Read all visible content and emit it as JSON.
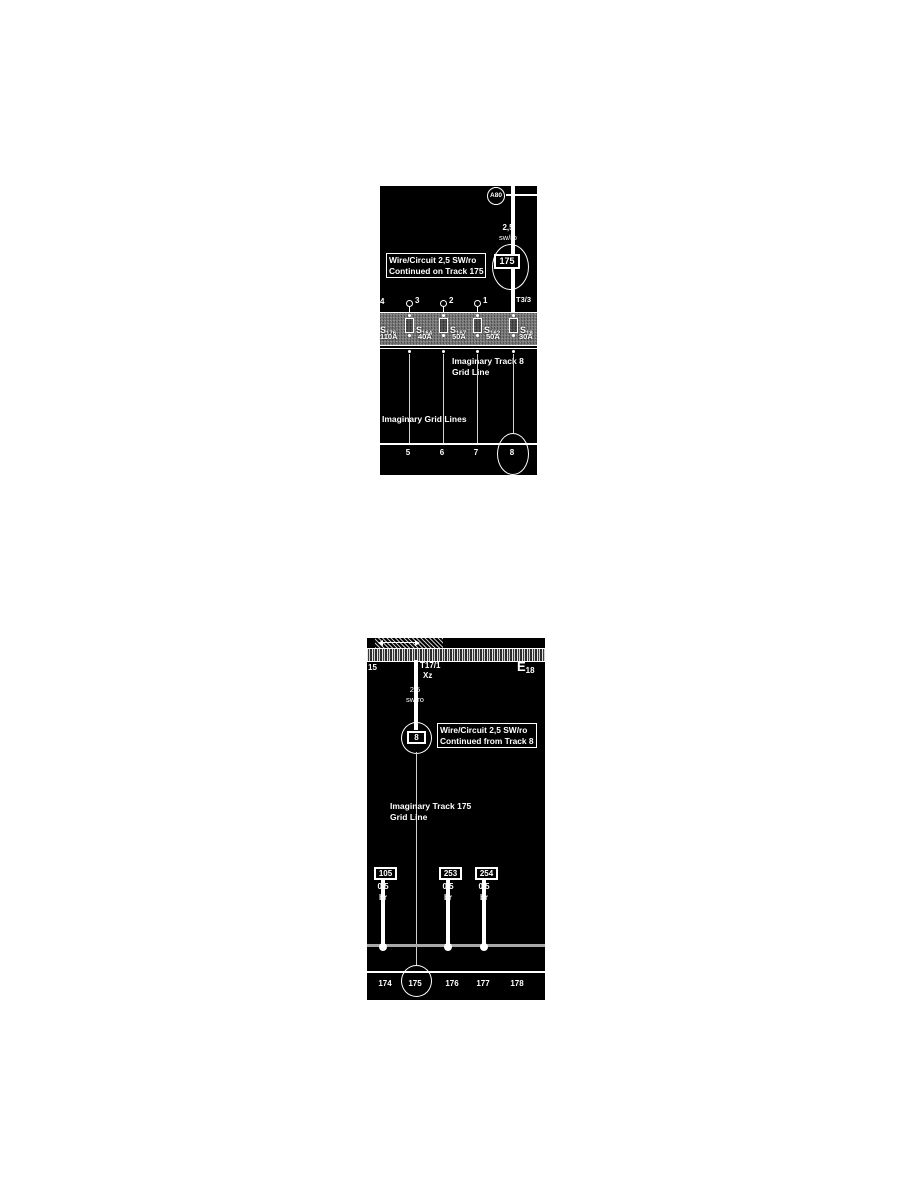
{
  "colors": {
    "page_bg": "#ffffff",
    "diagram_bg": "#000000",
    "diagram_text": "#ffffff",
    "fuse_band_gray": "#777777",
    "ground_bus_gray": "#a8a8a8"
  },
  "diagram1": {
    "component_ref": "A80",
    "wire_size": "2,5",
    "wire_color": "sw/ro",
    "track_box": "175",
    "callout": {
      "line1": "Wire/Circuit 2,5 SW/ro",
      "line2": "Continued on Track 175"
    },
    "pins": {
      "p4": "4",
      "p3": "3",
      "p2": "2",
      "p1": "1"
    },
    "connector": "T3/3",
    "fuses": [
      {
        "name": "S",
        "sub": "176",
        "amp": "110A"
      },
      {
        "name": "S",
        "sub": "164",
        "amp": "40A"
      },
      {
        "name": "S",
        "sub": "167",
        "amp": "50A"
      },
      {
        "name": "S",
        "sub": "162",
        "amp": "50A"
      },
      {
        "name": "S",
        "sub": "18",
        "amp": "30A"
      }
    ],
    "track8_note": {
      "line1": "Imaginary Track 8",
      "line2": "Grid Line"
    },
    "grid_note": "Imaginary Grid Lines",
    "tracks": [
      "5",
      "6",
      "7",
      "8"
    ],
    "circled_track": "8"
  },
  "diagram2": {
    "band_left_label": "15",
    "connector": "T17/1",
    "connector_sub": "Xz",
    "component_ref": {
      "main": "E",
      "sub": "18"
    },
    "wire_size": "2,5",
    "wire_color": "sw/ro",
    "track_box": "8",
    "callout": {
      "line1": "Wire/Circuit 2,5 SW/ro",
      "line2": "Continued from Track 8"
    },
    "track175_note": {
      "line1": "Imaginary Track 175",
      "line2": "Grid Line"
    },
    "grounds": [
      {
        "ref": "105",
        "size": "0,5",
        "color": "br"
      },
      {
        "ref": "253",
        "size": "0,5",
        "color": "br"
      },
      {
        "ref": "254",
        "size": "0,5",
        "color": "br"
      }
    ],
    "tracks": [
      "174",
      "175",
      "176",
      "177",
      "178"
    ],
    "circled_track": "175"
  }
}
